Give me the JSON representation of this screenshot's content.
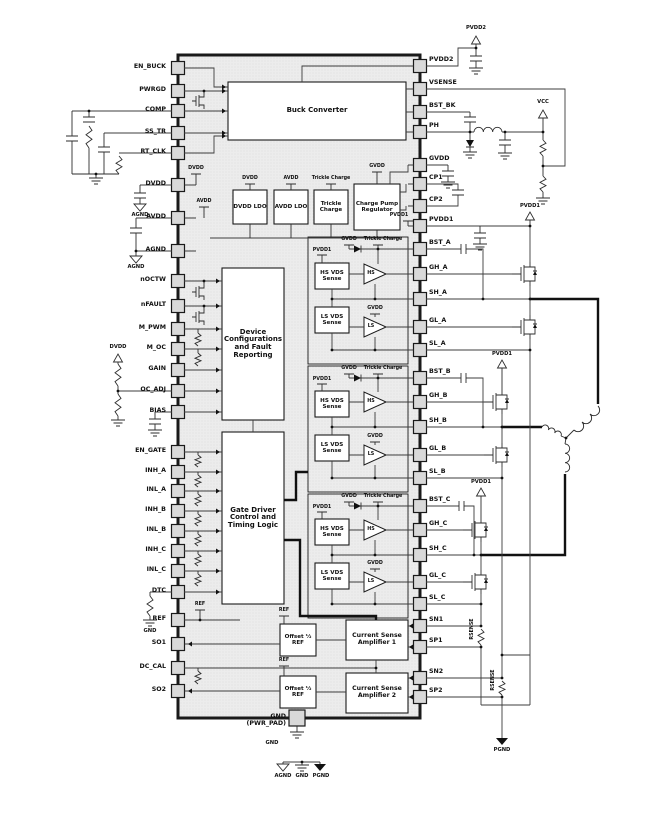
{
  "chip": {
    "left_pins": [
      "EN_BUCK",
      "PWRGD",
      "COMP",
      "SS_TR",
      "RT_CLK",
      "DVDD",
      "AVDD",
      "AGND",
      "nOCTW",
      "nFAULT",
      "M_PWM",
      "M_OC",
      "GAIN",
      "OC_ADJ",
      "BIAS",
      "EN_GATE",
      "INH_A",
      "INL_A",
      "INH_B",
      "INL_B",
      "INH_C",
      "INL_C",
      "DTC",
      "REF",
      "SO1",
      "DC_CAL",
      "SO2"
    ],
    "right_pins": [
      "PVDD2",
      "VSENSE",
      "BST_BK",
      "PH",
      "GVDD",
      "CP1",
      "CP2",
      "PVDD1",
      "BST_A",
      "GH_A",
      "SH_A",
      "GL_A",
      "SL_A",
      "BST_B",
      "GH_B",
      "SH_B",
      "GL_B",
      "SL_B",
      "BST_C",
      "GH_C",
      "SH_C",
      "GL_C",
      "SL_C",
      "SN1",
      "SP1",
      "SN2",
      "SP2"
    ],
    "pad_pin_label": "GND (PWR_PAD)",
    "pad_gnd_label": "GND",
    "blocks": {
      "buck": "Buck Converter",
      "dvdd_ldo": "DVDD LDO",
      "avdd_ldo": "AVDD LDO",
      "trickle": "Trickle Charge",
      "charge_pump": "Charge Pump Regulator",
      "device_config": "Device Configurations and Fault Reporting",
      "gate_driver": "Gate Driver Control and Timing Logic",
      "hs_sense": "HS VDS Sense",
      "ls_sense": "LS VDS Sense",
      "hs_amp": "HS",
      "ls_amp": "LS",
      "offset_ref": "Offset ½ REF",
      "csa1": "Current Sense Amplifier 1",
      "csa2": "Current Sense Amplifier 2"
    },
    "nets": {
      "dvdd": "DVDD",
      "avdd": "AVDD",
      "gvdd": "GVDD",
      "pvdd1": "PVDD1",
      "pvdd2": "PVDD2",
      "trickle": "Trickle Charge",
      "ref": "REF",
      "vcc": "VCC",
      "agnd": "AGND",
      "gnd": "GND",
      "pgnd": "PGND",
      "rsense": "RSENSE"
    },
    "legend": {
      "agnd": "AGND",
      "gnd": "GND",
      "pgnd": "PGND"
    }
  }
}
